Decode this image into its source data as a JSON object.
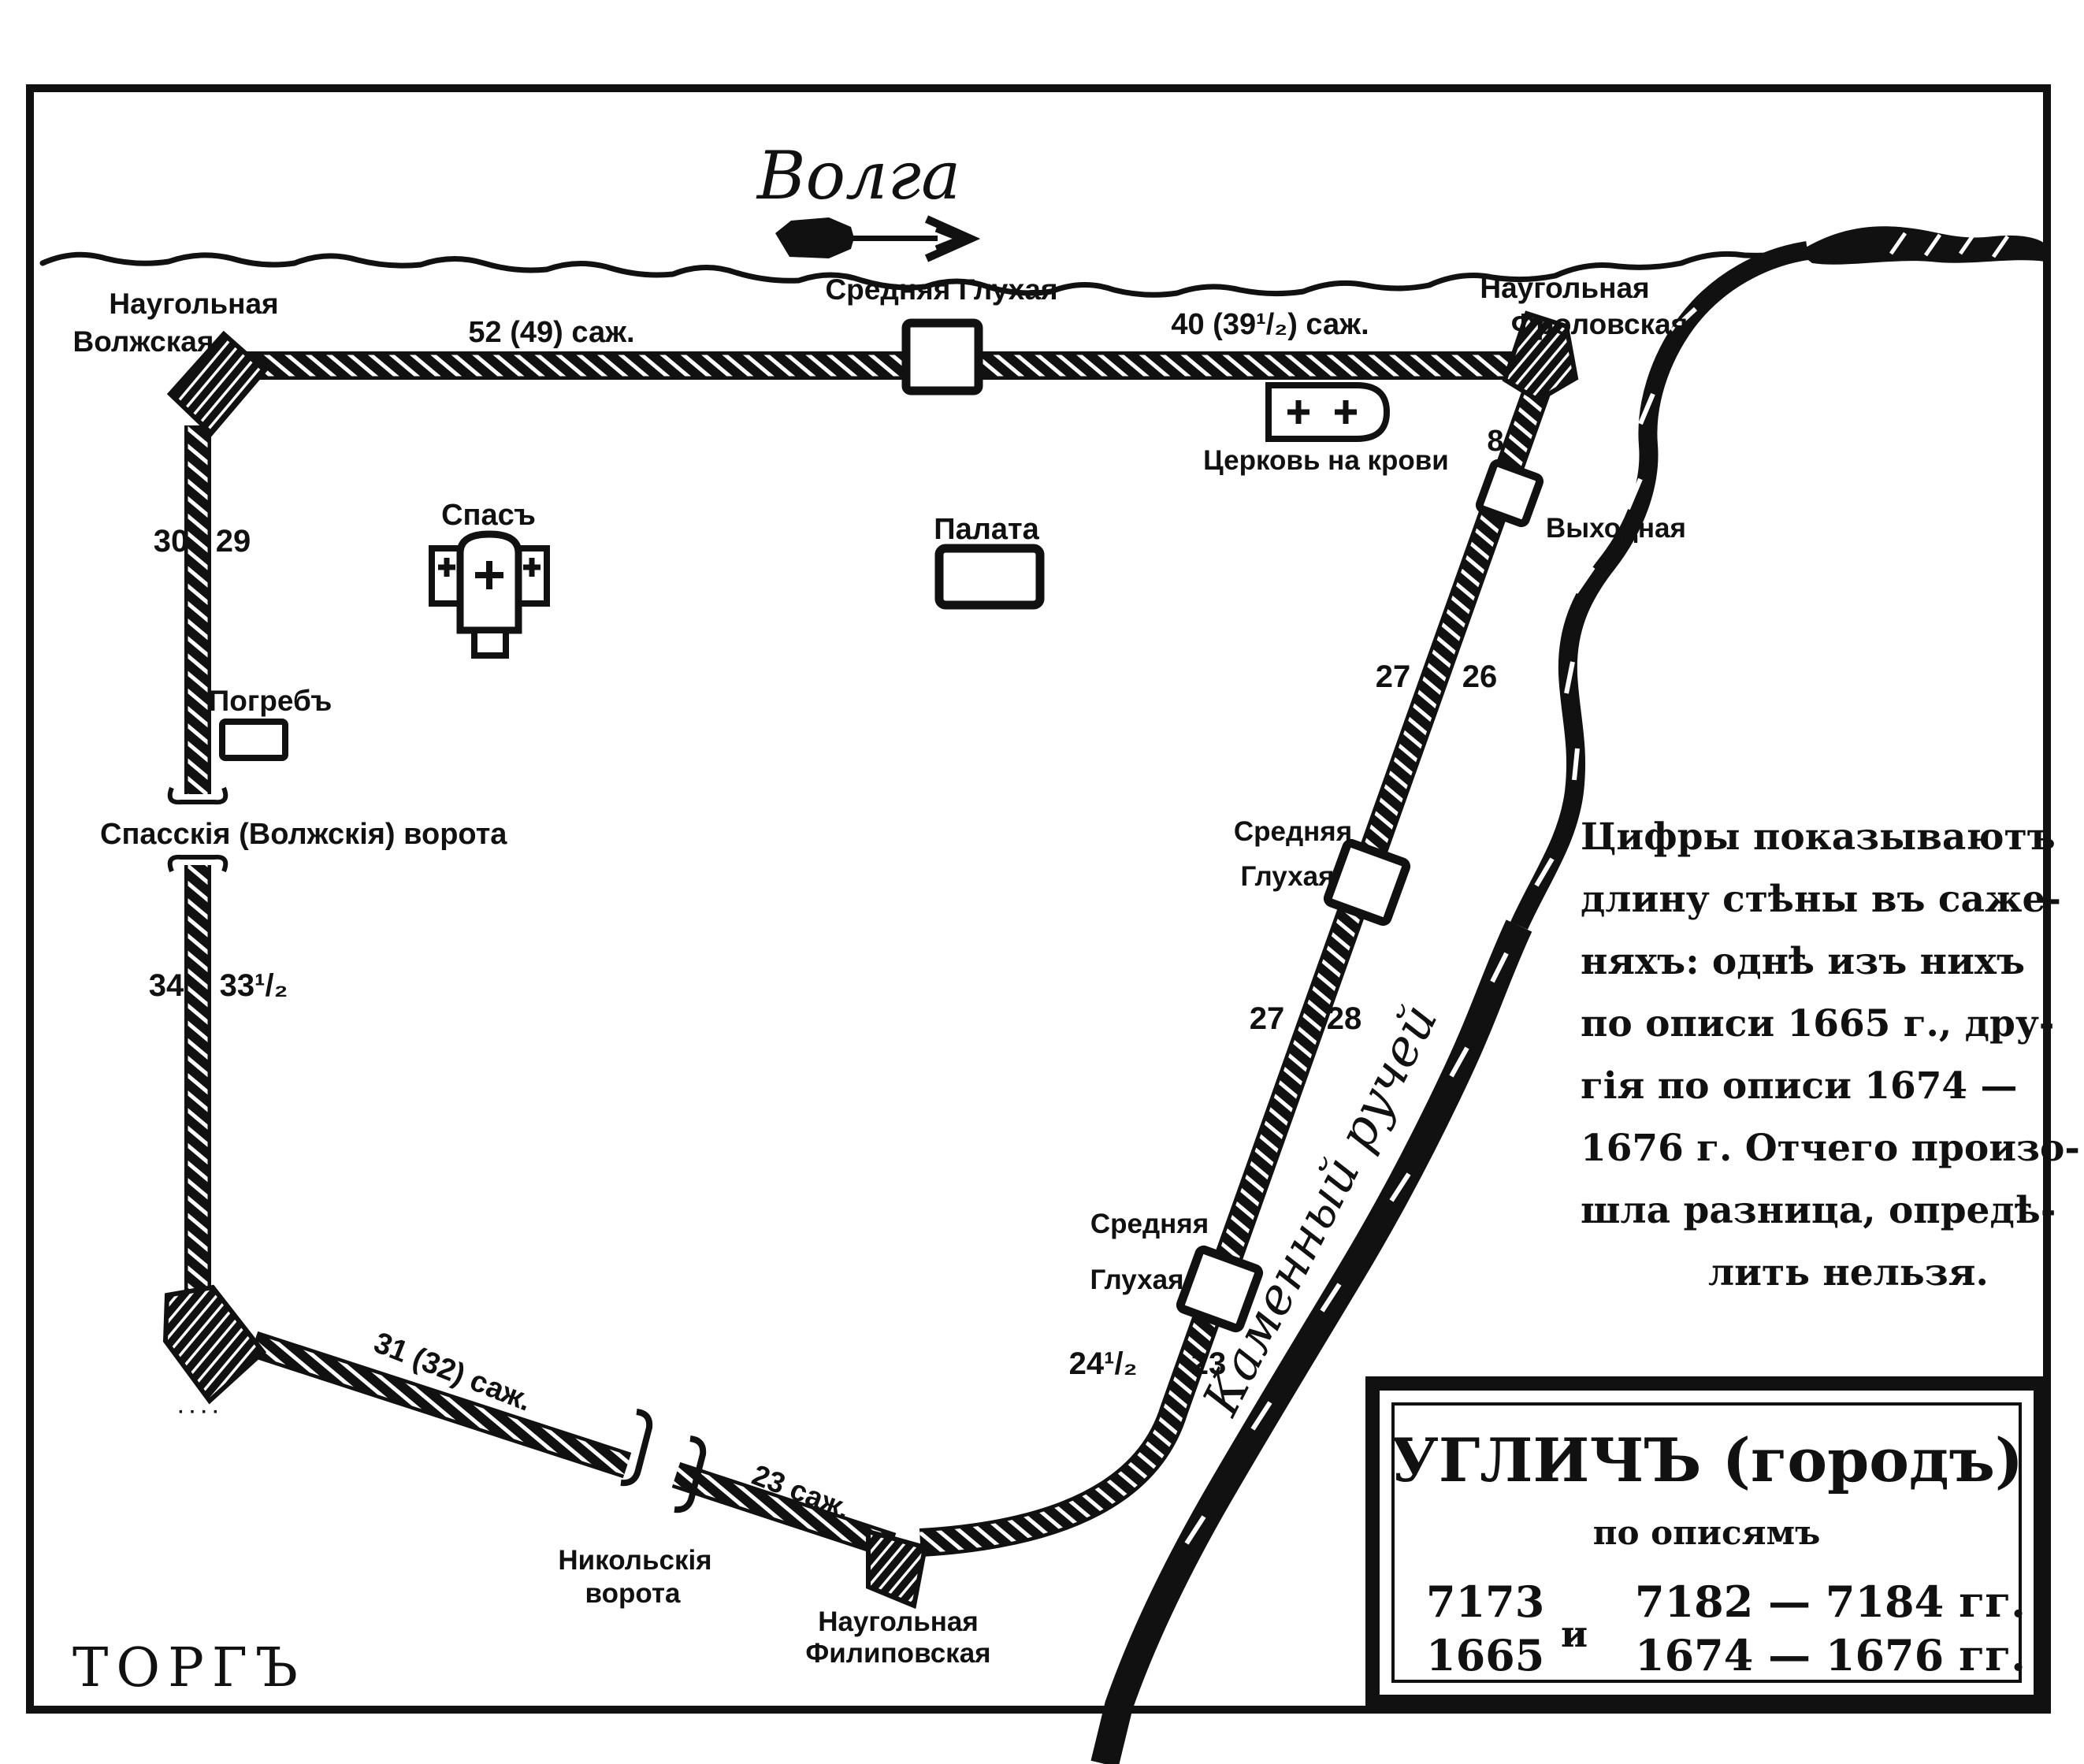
{
  "colors": {
    "ink": "#111111",
    "paper": "#ffffff"
  },
  "river": {
    "title": "Волга"
  },
  "stream": {
    "label": "Каменный ручей"
  },
  "area": {
    "torg": "ТОРГЪ"
  },
  "towers": {
    "nw_line1": "Наугольная",
    "nw_line2": "Волжская",
    "ne_line1": "Наугольная",
    "ne_line2": "Фроловская",
    "top_middle": "Средняя  Глухая",
    "vykhodnaya": "Выходная",
    "east_upper_line1": "Средняя",
    "east_upper_line2": "Глухая",
    "east_lower_line1": "Средняя",
    "east_lower_line2": "Глухая",
    "se_line1": "Наугольная",
    "se_line2": "Филиповская",
    "sw_small_label": "· · · ·"
  },
  "gates": {
    "spassky": "Спасскія (Волжскія) ворота",
    "nikolsky_line1": "Никольскія",
    "nikolsky_line2": "ворота"
  },
  "buildings": {
    "spas": "Спасъ",
    "palata": "Палата",
    "pogreb": "Погребъ",
    "church_on_blood": "Церковь на крови"
  },
  "wall_lengths": {
    "top_left": "52 (49) саж.",
    "top_right": "40 (39¹/₂) саж.",
    "south_west": "31 (32) саж.",
    "south": "23 саж."
  },
  "wall_numbers": {
    "west_upper_outer": "30",
    "west_upper_inner": "29",
    "west_lower_outer": "34",
    "west_lower_inner": "33¹/₂",
    "east_top": "8",
    "east_upper_outer": "27",
    "east_upper_inner": "26",
    "east_middle_outer": "27",
    "east_middle_inner": "28",
    "east_lower_outer": "24¹/₂",
    "east_lower_inner": "23"
  },
  "note": {
    "lines": [
      "Цифры показываютъ",
      "длину стѣны въ саже-",
      "няхъ: однѣ изъ нихъ",
      "по описи 1665 г., дру-",
      "гія по описи 1674 —",
      "1676 г. Отчего произо-",
      "шла разница, опредѣ-",
      "лить нельзя."
    ]
  },
  "title_box": {
    "title": "УГЛИЧЪ (городъ)",
    "subtitle": "по описямъ",
    "col_left_row1": "7173",
    "col_left_row2": "1665",
    "conjunction": "и",
    "col_right_row1": "7182 — 7184 гг.",
    "col_right_row2": "1674 — 1676 гг."
  }
}
